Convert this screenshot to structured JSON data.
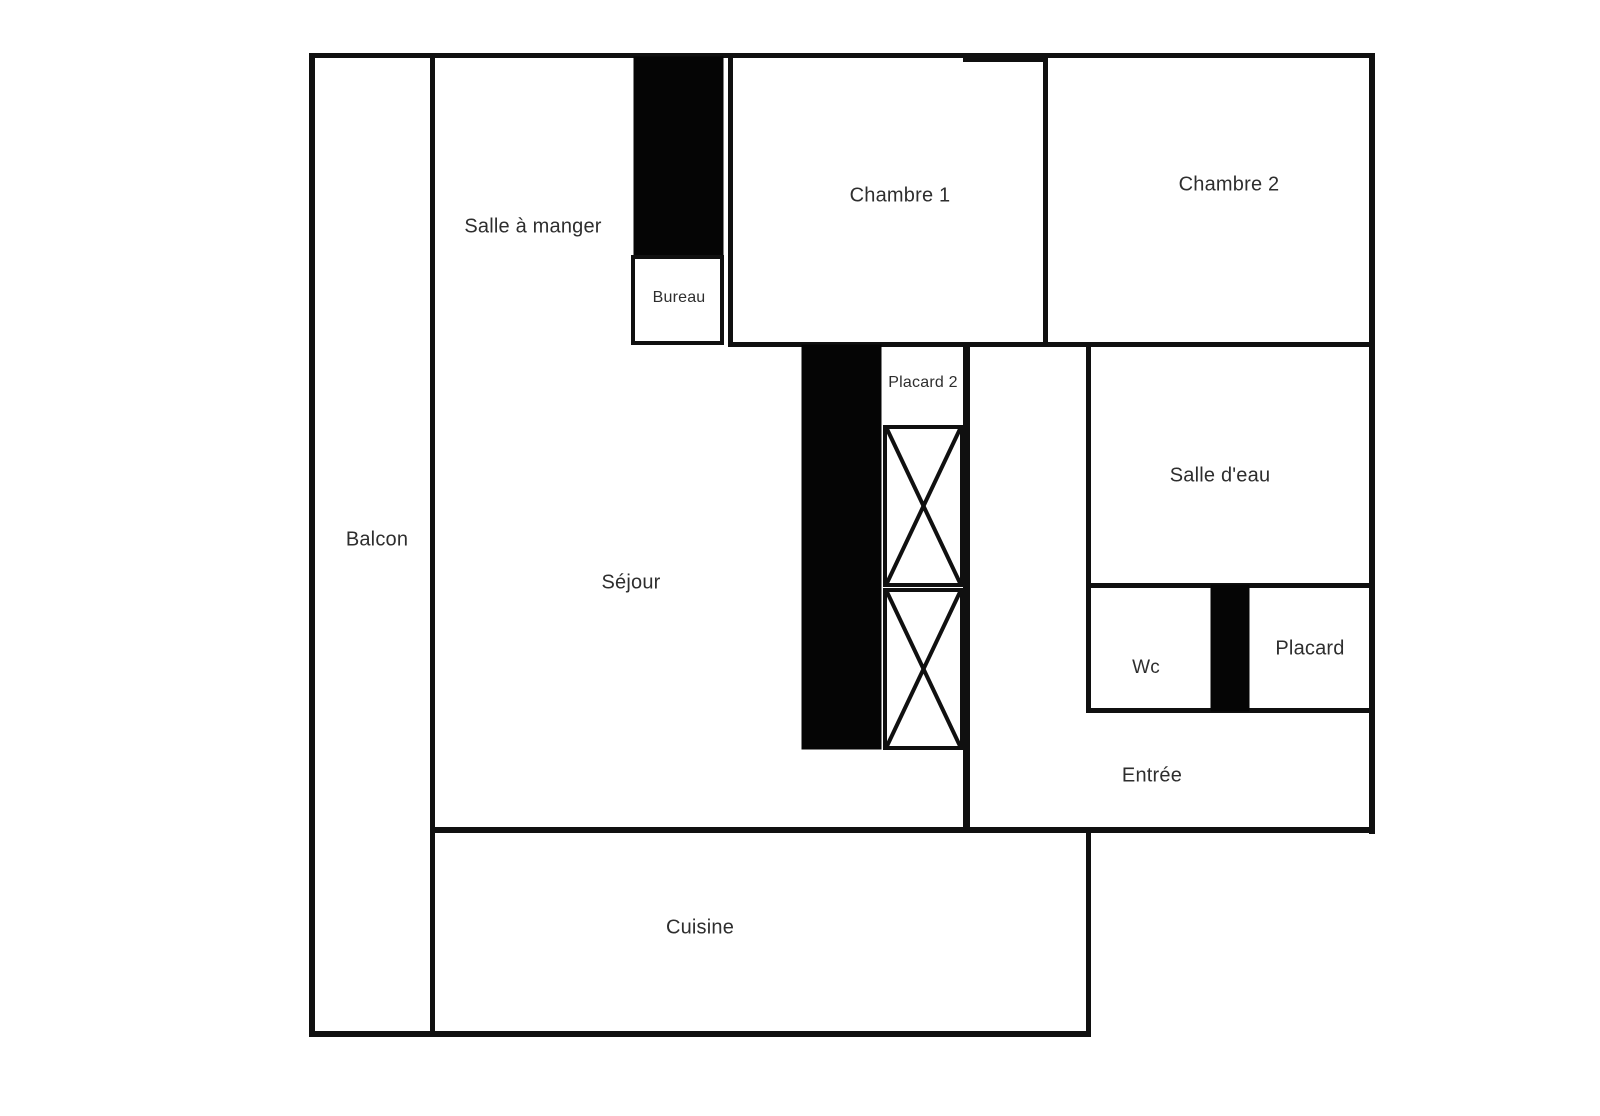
{
  "floor_plan": {
    "background_color": "#ffffff",
    "wall_color": "#101010",
    "label_color": "#2e2e2e",
    "rooms": {
      "balcon": {
        "label": "Balcon"
      },
      "salle_a_manger": {
        "label": "Salle à manger"
      },
      "bureau": {
        "label": "Bureau"
      },
      "chambre1": {
        "label": "Chambre 1"
      },
      "chambre2": {
        "label": "Chambre 2"
      },
      "placard2": {
        "label": "Placard 2"
      },
      "sejour": {
        "label": "Séjour"
      },
      "salle_deau": {
        "label": "Salle d'eau"
      },
      "wc": {
        "label": "Wc"
      },
      "placard": {
        "label": "Placard"
      },
      "entree": {
        "label": "Entrée"
      },
      "cuisine": {
        "label": "Cuisine"
      }
    }
  }
}
